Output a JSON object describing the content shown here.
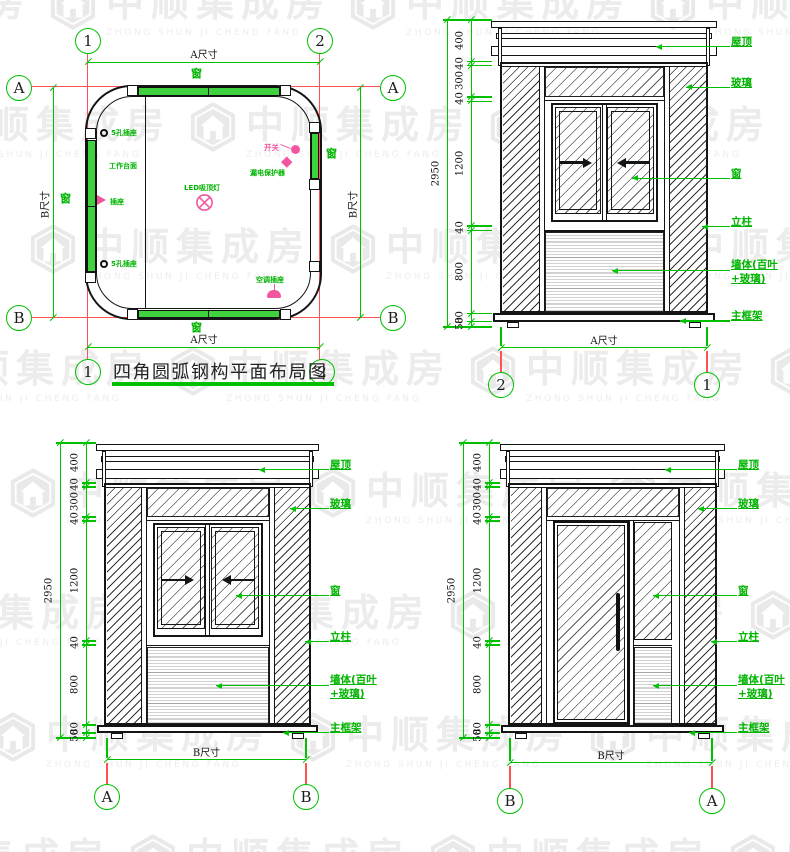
{
  "watermark": {
    "brand": "中顺集成房",
    "brand_latin": "ZHONG SHUN JI CHENG FANG"
  },
  "colors": {
    "annotation_green": "#00c000",
    "axis_red": "#ff5252",
    "symbol_pink": "#f0579f",
    "line_black": "#141414",
    "watermark_gray": "#ececec"
  },
  "plan": {
    "title": "四角圆弧钢构平面布局图",
    "grid_cols": [
      "1",
      "2"
    ],
    "grid_rows": [
      "A",
      "B"
    ],
    "dim_width": "A尺寸",
    "dim_depth": "B尺寸",
    "labels": {
      "window_top": "窗",
      "window_bottom": "窗",
      "window_left": "窗",
      "window_right": "窗",
      "socket_top_left": "5孔插座",
      "worktop": "工作台面",
      "socket_left": "插座",
      "socket_bottom_left": "5孔插座",
      "ceiling_lamp": "LED吸顶灯",
      "switch": "开关",
      "breaker": "漏电保护器",
      "ac_socket": "空调插座"
    }
  },
  "elevations": [
    {
      "name": "front-elevation",
      "left_axis": "2",
      "right_axis": "1",
      "width_label": "A尺寸",
      "total": "2950",
      "segments": [
        "400",
        "40",
        "300",
        "40",
        "1200",
        "40",
        "800",
        "80",
        "50"
      ],
      "labels": {
        "roof": "屋顶",
        "glass": "玻璃",
        "window": "窗",
        "column": "立柱",
        "wall": "墙体(百叶+玻璃)",
        "frame": "主框架"
      }
    },
    {
      "name": "side-elevation-ab",
      "left_axis": "A",
      "right_axis": "B",
      "width_label": "B尺寸",
      "total": "2950",
      "segments": [
        "400",
        "40",
        "300",
        "40",
        "1200",
        "40",
        "800",
        "80",
        "50"
      ],
      "labels": {
        "roof": "屋顶",
        "glass": "玻璃",
        "window": "窗",
        "column": "立柱",
        "wall": "墙体(百叶+玻璃)",
        "frame": "主框架"
      }
    },
    {
      "name": "side-elevation-ba",
      "left_axis": "B",
      "right_axis": "A",
      "width_label": "B尺寸",
      "total": "2950",
      "segments": [
        "400",
        "40",
        "300",
        "40",
        "1200",
        "40",
        "800",
        "80",
        "50"
      ],
      "labels": {
        "roof": "屋顶",
        "glass": "玻璃",
        "window": "窗",
        "column": "立柱",
        "wall": "墙体(百叶+玻璃)",
        "frame": "主框架"
      }
    }
  ]
}
